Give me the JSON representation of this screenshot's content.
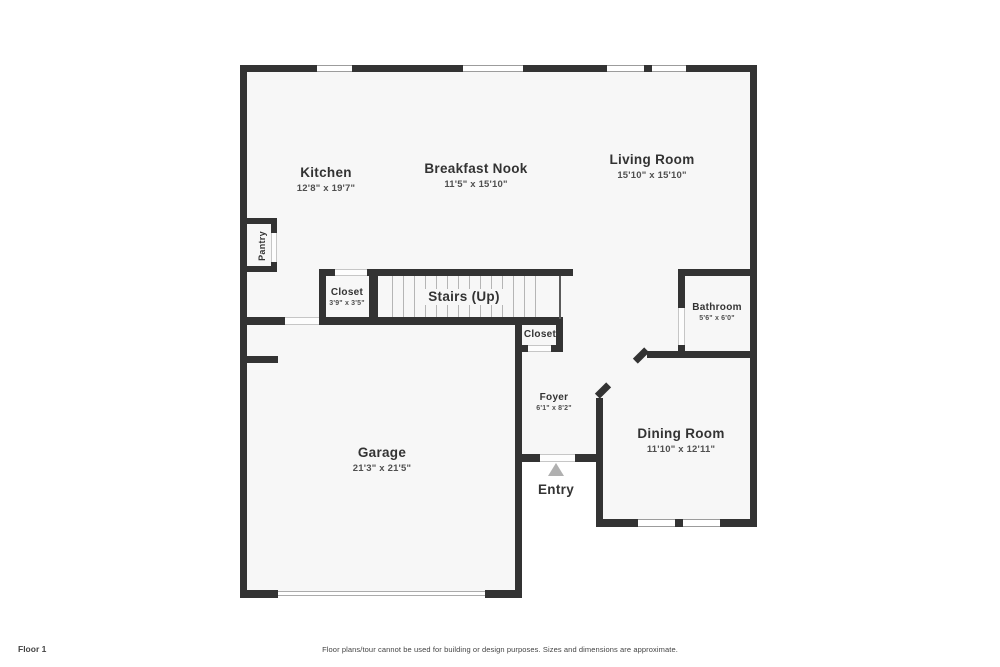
{
  "rooms": {
    "kitchen": {
      "label": "Kitchen",
      "dims": "12'8\" x 19'7\""
    },
    "breakfast_nook": {
      "label": "Breakfast Nook",
      "dims": "11'5\" x 15'10\""
    },
    "living_room": {
      "label": "Living Room",
      "dims": "15'10\" x 15'10\""
    },
    "pantry": {
      "label": "Pantry"
    },
    "stairs_closet": {
      "label": "Closet",
      "dims": "3'9\" x 3'5\""
    },
    "stairs": {
      "label": "Stairs (Up)"
    },
    "hall_closet": {
      "label": "Closet"
    },
    "bathroom": {
      "label": "Bathroom",
      "dims": "5'6\" x 6'0\""
    },
    "foyer": {
      "label": "Foyer",
      "dims": "6'1\" x 8'2\""
    },
    "dining_room": {
      "label": "Dining Room",
      "dims": "11'10\" x 12'11\""
    },
    "garage": {
      "label": "Garage",
      "dims": "21'3\" x 21'5\""
    },
    "entry": {
      "label": "Entry"
    }
  },
  "footer": {
    "floor_label": "Floor 1",
    "disclaimer": "Floor plans/tour cannot be used for building or design purposes. Sizes and dimensions are approximate."
  },
  "colors": {
    "wall": "#333333",
    "floor": "#f7f7f7",
    "window_line": "#9c9c9c",
    "door_line": "#c6c6c6",
    "tread_line": "#b5b5b5",
    "entry_arrow": "#b0b0b0",
    "label_text": "#333333",
    "dims_text": "#4f4f4f",
    "footer_text": "#444444"
  }
}
